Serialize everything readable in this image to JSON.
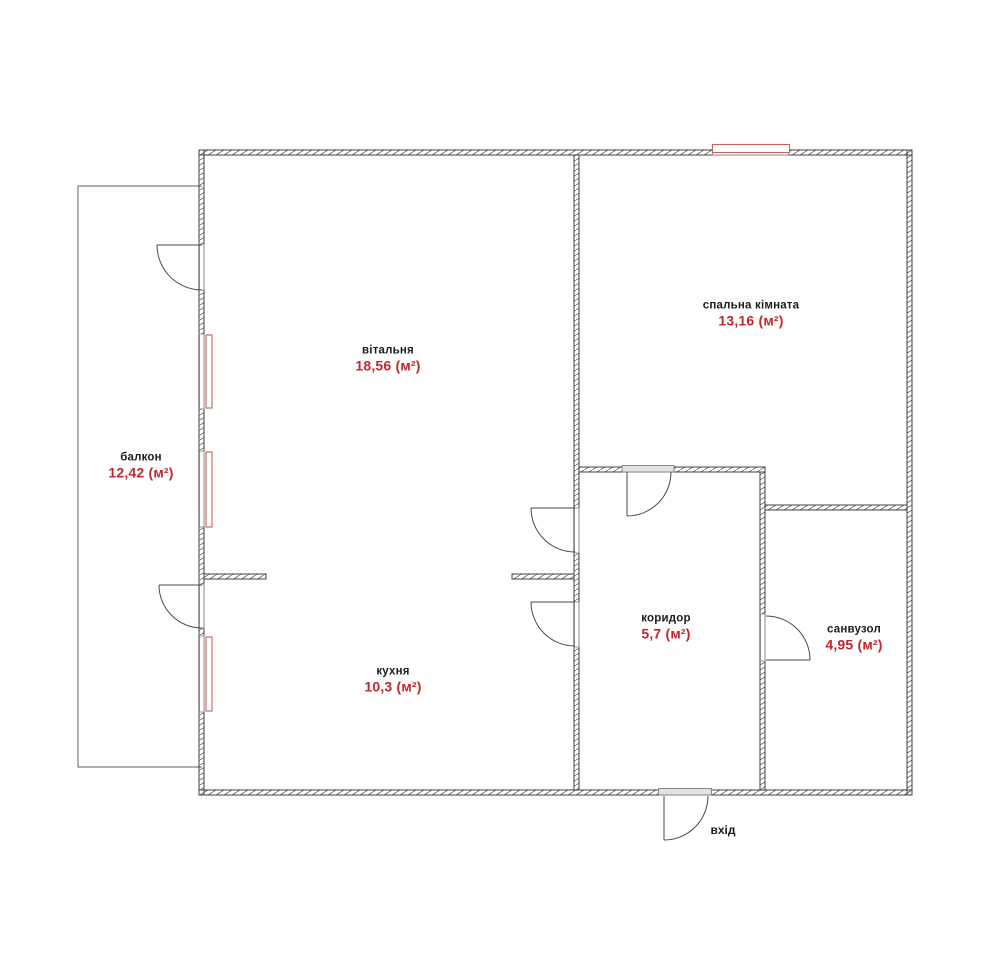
{
  "plan": {
    "rooms": [
      {
        "id": "living-room",
        "name": "вітальня",
        "area": "18,56 (м²)"
      },
      {
        "id": "bedroom",
        "name": "спальна кімната",
        "area": "13,16 (м²)"
      },
      {
        "id": "balcony",
        "name": "балкон",
        "area": "12,42 (м²)"
      },
      {
        "id": "kitchen",
        "name": "кухня",
        "area": "10,3 (м²)"
      },
      {
        "id": "corridor",
        "name": "коридор",
        "area": "5,7 (м²)"
      },
      {
        "id": "bathroom",
        "name": "санвузол",
        "area": "4,95 (м²)"
      }
    ],
    "entrance": {
      "label": "вхід"
    },
    "colors": {
      "wall_line": "#3f3f3f",
      "hatch": "#6e6e6e",
      "window_red": "#c4635b",
      "area_text": "#c0272d",
      "room_text": "#1d1d1d",
      "balcony_line": "#7d7d7d",
      "threshold": "#7c7c7c"
    }
  }
}
